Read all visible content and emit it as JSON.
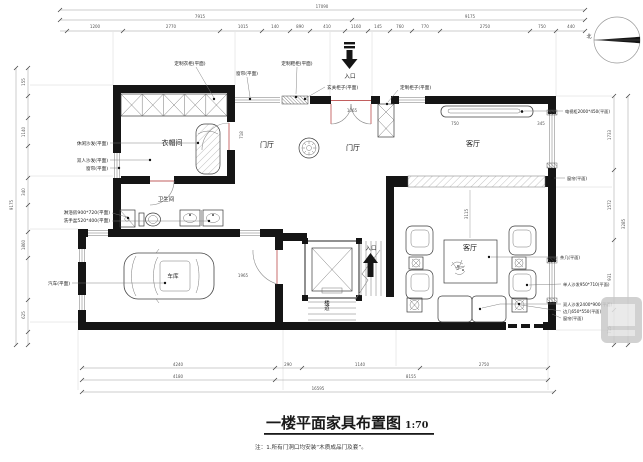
{
  "title": {
    "text": "一楼平面家具布置图",
    "scale": "1:70"
  },
  "note": "注：1.所有门洞口均安装“木质成品门及套”。",
  "compass": {
    "north": "北"
  },
  "entrance": {
    "label": "入口"
  },
  "rooms": {
    "cloakroom": "衣帽间",
    "bathroom": "卫生间",
    "garage": "车库",
    "foyer": "门厅",
    "living": "客厅",
    "stairwell": "楼道"
  },
  "labels": {
    "top": [
      "定制衣柜(平面)",
      "窗帘(平面)",
      "定制鞋柜(平面)",
      "玄关柜子(平面)",
      "定制柜子(平面)"
    ],
    "left": [
      "休闲沙发(平面)",
      "双人沙发(平面)",
      "窗帘(平面)",
      "淋浴房900*720(平面)",
      "洗手盆520*400(平面)",
      "汽车(平面)"
    ],
    "right": [
      "电视柜2000*450(平面)",
      "窗帘(平面)",
      "茶几(平面)",
      "单人沙发950*710(平面)",
      "双人沙发2400*900(平面)",
      "边几650*550(平面)",
      "窗帘(平面)"
    ]
  },
  "dimensions": {
    "top_total": "17090",
    "top_row2": [
      "7915",
      "9175"
    ],
    "top_row3": [
      "1200",
      "2770",
      "1015",
      "140",
      "890",
      "410",
      "1160",
      "145",
      "760",
      "770",
      "2750",
      "750",
      "440"
    ],
    "left_col": [
      "155",
      "1140",
      "340",
      "1860",
      "625"
    ],
    "left_total": "9175",
    "right_col": [
      "1733",
      "1572",
      "931",
      "715"
    ],
    "right_total": "3285",
    "bottom_row1": [
      "4240",
      "290",
      "1140",
      "2750"
    ],
    "bottom_row2": [
      "4180",
      "8155"
    ],
    "bottom_total": "16595",
    "interior": [
      "718",
      "1065",
      "3115",
      "750",
      "345",
      "1965"
    ]
  }
}
